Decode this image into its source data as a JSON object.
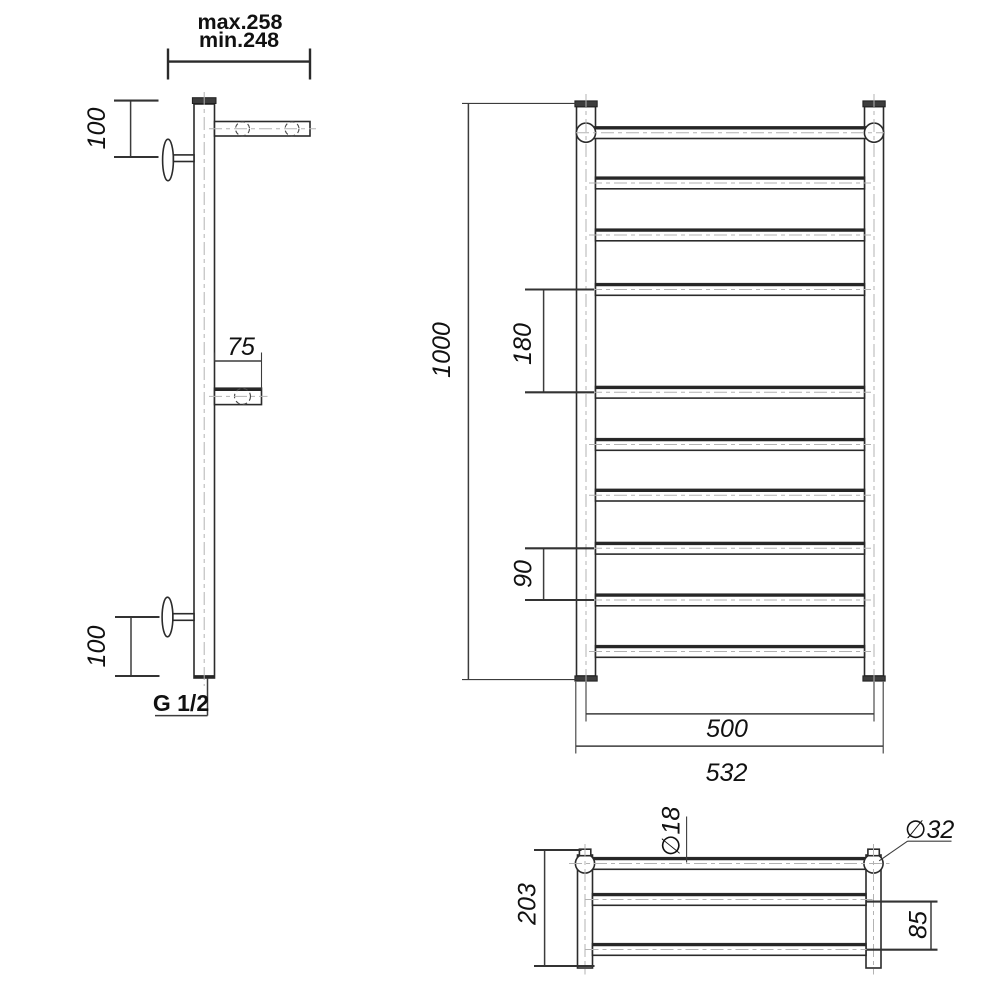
{
  "dimensions": {
    "side": {
      "bracket_max": "max.258",
      "bracket_min": "min.248",
      "top_offset": "100",
      "shelf_depth": "75",
      "bottom_offset": "100",
      "thread": "G 1/2"
    },
    "front": {
      "height": "1000",
      "wide_gap": "180",
      "rung_gap": "90",
      "axis_width": "500",
      "overall_width": "532"
    },
    "top": {
      "depth": "203",
      "shelf_gap": "85",
      "rail_diameter": "∅18",
      "collector_diameter": "∅32"
    }
  },
  "structure": {
    "rung_count": 10,
    "shelf_rail_count": 2,
    "colors": {
      "line": "#2b2b2b",
      "centerline": "#b3b3b3",
      "dimension": "#3c3c3c",
      "background": "#ffffff"
    }
  }
}
